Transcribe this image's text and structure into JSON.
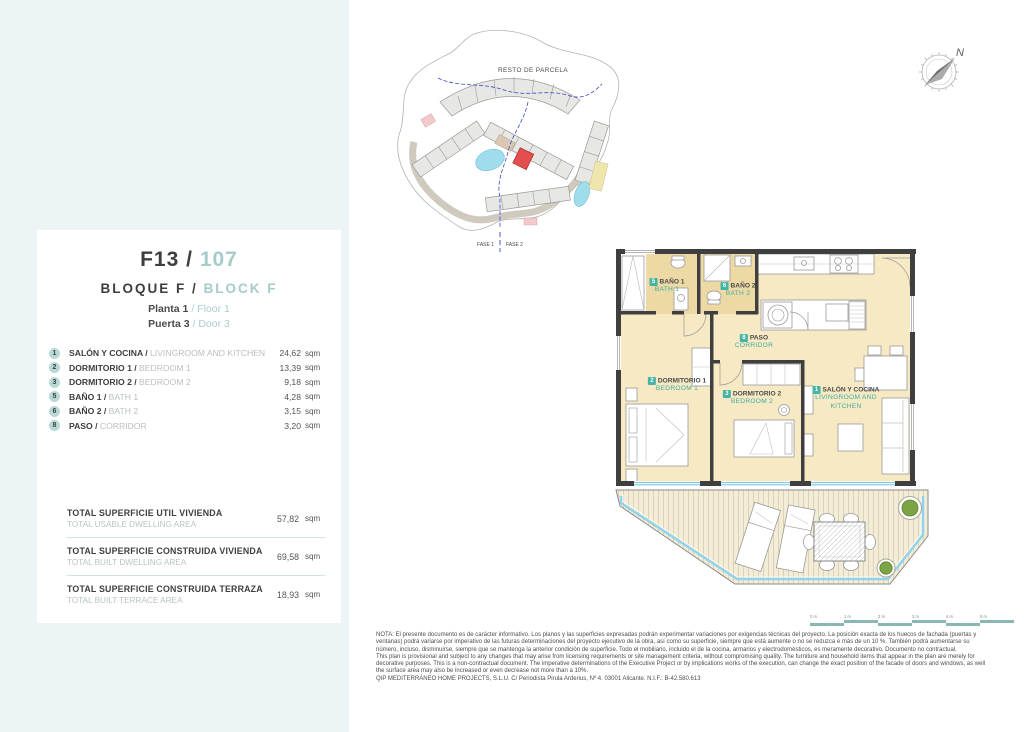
{
  "strings": {
    "sep": "/"
  },
  "unit_card": {
    "unit_code": "F13",
    "unit_number": "107",
    "block_es": "BLOQUE F",
    "block_en": "BLOCK F",
    "floor_es": "Planta 1",
    "floor_en": "Floor 1",
    "door_es": "Puerta 3",
    "door_en": "Door 3"
  },
  "rooms": [
    {
      "num": "1",
      "name_es": "SALÓN Y COCINA",
      "name_en": "LIVINGROOM AND KITCHEN",
      "area": "24,62",
      "unit": "sqm"
    },
    {
      "num": "2",
      "name_es": "DORMITORIO 1",
      "name_en": "BEDROOM 1",
      "area": "13,39",
      "unit": "sqm"
    },
    {
      "num": "3",
      "name_es": "DORMITORIO 2",
      "name_en": "BEDROOM 2",
      "area": "9,18",
      "unit": "sqm"
    },
    {
      "num": "5",
      "name_es": "BAÑO 1",
      "name_en": "BATH 1",
      "area": "4,28",
      "unit": "sqm"
    },
    {
      "num": "6",
      "name_es": "BAÑO 2",
      "name_en": "BATH 2",
      "area": "3,15",
      "unit": "sqm"
    },
    {
      "num": "8",
      "name_es": "PASO",
      "name_en": "CORRIDOR",
      "area": "3,20",
      "unit": "sqm"
    }
  ],
  "totals": [
    {
      "label_es": "TOTAL SUPERFICIE UTIL VIVIENDA",
      "label_en": "TOTAL USABLE DWELLING AREA",
      "value": "57,82",
      "unit": "sqm"
    },
    {
      "label_es": "TOTAL SUPERFICIE CONSTRUIDA VIVIENDA",
      "label_en": "TOTAL BUILT DWELLING AREA",
      "value": "69,58",
      "unit": "sqm"
    },
    {
      "label_es": "TOTAL SUPERFICIE CONSTRUIDA TERRAZA",
      "label_en": "TOTAL BUILT TERRACE AREA",
      "value": "18,93",
      "unit": "sqm"
    }
  ],
  "site_plan": {
    "resto_label": "RESTO DE PARCELA",
    "fase1": "FASE 1",
    "fase2": "FASE 2"
  },
  "compass": {
    "north_label": "N"
  },
  "floor_plan_labels": [
    {
      "num": "5",
      "es": "BAÑO 1",
      "en": "BATH 1"
    },
    {
      "num": "6",
      "es": "BAÑO 2",
      "en": "BATH 2"
    },
    {
      "num": "8",
      "es": "PASO",
      "en": "CORRIDOR"
    },
    {
      "num": "2",
      "es": "DORMITORIO 1",
      "en": "BEDROOM 1"
    },
    {
      "num": "3",
      "es": "DORMITORIO 2",
      "en": "BEDROOM 2"
    },
    {
      "num": "1",
      "es": "SALÓN Y COCINA",
      "en": "LIVINGROOM AND KITCHEN"
    }
  ],
  "scale_bar": {
    "labels": [
      "0 m",
      "1 m",
      "2 m",
      "3 m",
      "4 m",
      "5 m"
    ]
  },
  "legal": {
    "nota_es": "NOTA: El presente documento es de carácter informativo. Los planos y las superficies expresadas podrán experimentar variaciones por exigencias técnicas del proyecto. La posición exacta de los huecos de fachada (puertas y ventanas) podrá variarse por imperativo de las futuras determinaciones del proyecto ejecutivo de la obra, así como su superficie, siempre que está aumente o no se reduzca e más de un 10 %. También podrá aumentarse su número, incluso, disminuirse, siempre que se mantenga la anterior condición de superficie. Todo el mobiliario, incluido el de la cocina, armarios y electrodomésticos, es meramente decorativo. Documento no contractual.",
    "nota_en": "This plan is provisional and subject to any changes that may arise from licensing requirements or site management criteria, without compromising quality. The furniture and household items that appear in the plan are merely for decorative purposes. This is a non-contractual document. The imperative determinations of the Executive Project or by implications works of the execution, can change the exact position of the facade of doors and windows, as well the surface area may also be increased or even decrease not more than a 10%.",
    "company": "QIP MEDITERRÁNEO HOME PROJECTS, S.L.U. C/ Periodista Pirula Arderius, Nº 4. 03001 Alicante. N.I.F.: B-42.580.613"
  }
}
